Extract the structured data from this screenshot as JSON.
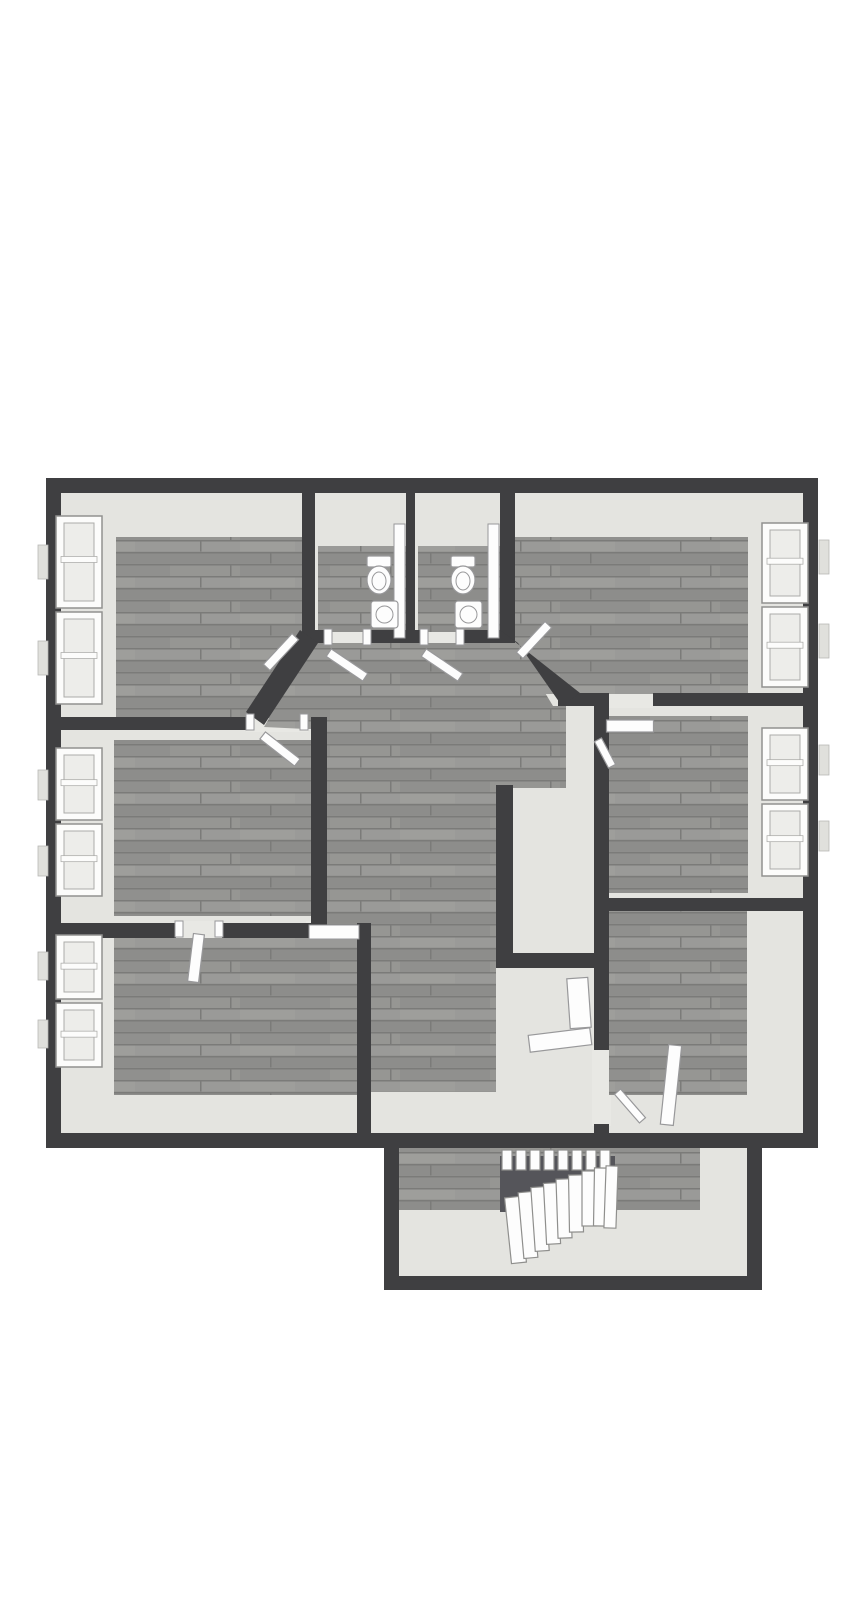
{
  "canvas": {
    "width": 867,
    "height": 1600,
    "background": "#ffffff"
  },
  "palette": {
    "wall": "#3f3f41",
    "floor_light": "#e4e4e0",
    "gap_light": "#e8e8e4",
    "wood_base": "#90908e",
    "wood_row_light": "#9a9a98",
    "wood_row_mid": "#8d8d8b",
    "wood_seam": "#7b7b79",
    "wood_streak": "#a2a2a0",
    "void": "#55555a",
    "white_fixture": "#fdfdfd",
    "fixture_stroke": "#98989a",
    "window_frame": "#fcfcfb",
    "window_frame_stroke": "#91918f",
    "window_pane": "#ededea",
    "window_pane_stroke": "#ababa9",
    "tab_fill": "#e0e0dc",
    "tab_stroke": "#b5b5b3",
    "tread_fill": "#fdfdfd",
    "tread_stroke": "#8f8f8d"
  },
  "floorplan": {
    "light_regions": [
      {
        "name": "room-top-left-base",
        "rect": [
          61,
          493,
          241,
          226
        ]
      },
      {
        "name": "bathroom-left-base",
        "rect": [
          315,
          493,
          91,
          139
        ]
      },
      {
        "name": "bathroom-right-base",
        "rect": [
          415,
          493,
          85,
          139
        ]
      },
      {
        "name": "room-top-right-base",
        "rect": [
          515,
          493,
          288,
          202
        ]
      },
      {
        "name": "room-mid-left-base",
        "rect": [
          61,
          730,
          252,
          195
        ]
      },
      {
        "name": "room-mid-right-base",
        "rect": [
          609,
          706,
          194,
          194
        ]
      },
      {
        "name": "room-bottom-left-base",
        "rect": [
          61,
          938,
          296,
          197
        ]
      },
      {
        "name": "room-bottom-right-base",
        "rect": [
          609,
          911,
          194,
          224
        ]
      },
      {
        "name": "hallway-base",
        "poly": [
          [
            295,
            628
          ],
          [
            520,
            628
          ],
          [
            562,
            692
          ],
          [
            609,
            692
          ],
          [
            609,
            1133
          ],
          [
            368,
            1133
          ],
          [
            368,
            940
          ],
          [
            323,
            940
          ],
          [
            323,
            712
          ],
          [
            244,
            712
          ]
        ]
      },
      {
        "name": "stairwell-base",
        "rect": [
          399,
          1148,
          348,
          128
        ]
      },
      {
        "name": "doorway-threshold",
        "rect": [
          246,
          710,
          62,
          22
        ]
      },
      {
        "name": "doorway-threshold",
        "rect": [
          322,
          628,
          52,
          17
        ]
      },
      {
        "name": "doorway-threshold",
        "rect": [
          418,
          628,
          49,
          17
        ]
      },
      {
        "name": "doorway-threshold",
        "rect": [
          306,
          921,
          54,
          19
        ]
      },
      {
        "name": "doorway-threshold",
        "rect": [
          174,
          921,
          50,
          19
        ]
      },
      {
        "name": "doorway-threshold",
        "rect": [
          605,
          690,
          48,
          18
        ]
      },
      {
        "name": "doorway-threshold",
        "rect": [
          592,
          1046,
          19,
          80
        ]
      }
    ],
    "wood_regions": [
      {
        "name": "room-top-left-floor",
        "rect": [
          116,
          537,
          186,
          181
        ]
      },
      {
        "name": "bathroom-left-floor",
        "rect": [
          318,
          546,
          88,
          86
        ]
      },
      {
        "name": "bathroom-right-floor",
        "rect": [
          418,
          546,
          82,
          86
        ]
      },
      {
        "name": "room-top-right-floor",
        "rect": [
          515,
          537,
          233,
          157
        ]
      },
      {
        "name": "room-mid-left-floor",
        "rect": [
          114,
          740,
          199,
          176
        ]
      },
      {
        "name": "room-mid-right-floor",
        "rect": [
          609,
          716,
          139,
          177
        ]
      },
      {
        "name": "room-bottom-left-floor",
        "rect": [
          114,
          938,
          243,
          157
        ]
      },
      {
        "name": "room-bottom-right-floor",
        "rect": [
          609,
          911,
          138,
          184
        ]
      },
      {
        "name": "hallway-floor",
        "poly": [
          [
            312,
            643
          ],
          [
            515,
            643
          ],
          [
            553,
            706
          ],
          [
            566,
            706
          ],
          [
            566,
            788
          ],
          [
            496,
            788
          ],
          [
            496,
            1092
          ],
          [
            370,
            1092
          ],
          [
            370,
            938
          ],
          [
            327,
            938
          ],
          [
            327,
            730
          ],
          [
            264,
            727
          ]
        ]
      },
      {
        "name": "stairwell-floor-strip",
        "rect": [
          399,
          1148,
          301,
          62
        ]
      }
    ],
    "void": {
      "name": "stair-void",
      "rect": [
        500,
        1156,
        115,
        56
      ]
    },
    "stairs": {
      "upper": {
        "x": 502,
        "y": 1150,
        "w": 10,
        "h": 20,
        "gap": 4,
        "count": 8
      },
      "fan": [
        [
          508,
          1197,
          15,
          66,
          -6
        ],
        [
          521,
          1192,
          14,
          66,
          -5
        ],
        [
          533,
          1187,
          14,
          64,
          -4
        ],
        [
          545,
          1183,
          14,
          61,
          -3
        ],
        [
          557,
          1179,
          14,
          59,
          -2
        ],
        [
          569,
          1175,
          14,
          57,
          -1
        ],
        [
          582,
          1171,
          14,
          55,
          0
        ],
        [
          594,
          1168,
          14,
          58,
          1
        ],
        [
          605,
          1166,
          12,
          62,
          2
        ]
      ]
    },
    "walls": [
      {
        "name": "outer-wall-top",
        "rect": [
          46,
          478,
          772,
          15
        ]
      },
      {
        "name": "outer-wall-left",
        "rect": [
          46,
          478,
          15,
          670
        ]
      },
      {
        "name": "outer-wall-right",
        "rect": [
          803,
          478,
          15,
          670
        ]
      },
      {
        "name": "outer-wall-bottom",
        "rect": [
          46,
          1133,
          772,
          15
        ]
      },
      {
        "name": "stairwell-wall-left",
        "rect": [
          384,
          1148,
          15,
          142
        ]
      },
      {
        "name": "stairwell-wall-right",
        "rect": [
          747,
          1148,
          15,
          142
        ]
      },
      {
        "name": "stairwell-wall-bottom",
        "rect": [
          384,
          1276,
          378,
          14
        ]
      },
      {
        "name": "wall-topleft-bath",
        "rect": [
          302,
          492,
          13,
          140
        ]
      },
      {
        "name": "wall-between-baths",
        "rect": [
          406,
          492,
          9,
          140
        ]
      },
      {
        "name": "wall-bath-topright",
        "rect": [
          500,
          492,
          15,
          140
        ]
      },
      {
        "name": "wall-bath-bottom-a",
        "rect": [
          302,
          630,
          22,
          13
        ]
      },
      {
        "name": "wall-bath-bottom-b",
        "rect": [
          371,
          630,
          49,
          13
        ]
      },
      {
        "name": "wall-bath-bottom-c",
        "rect": [
          464,
          630,
          51,
          13
        ]
      },
      {
        "name": "wall-topleft-bottom",
        "rect": [
          46,
          717,
          200,
          13
        ]
      },
      {
        "name": "wall-midleft-right",
        "rect": [
          311,
          717,
          16,
          210
        ]
      },
      {
        "name": "wall-midleft-bottom-a",
        "rect": [
          46,
          923,
          130,
          15
        ]
      },
      {
        "name": "wall-midleft-bottom-b",
        "rect": [
          222,
          923,
          89,
          15
        ]
      },
      {
        "name": "wall-bottomleft-right",
        "rect": [
          357,
          923,
          14,
          225
        ]
      },
      {
        "name": "wall-topright-bottom-a",
        "rect": [
          558,
          693,
          49,
          13
        ]
      },
      {
        "name": "wall-topright-bottom-b",
        "rect": [
          653,
          693,
          165,
          13
        ]
      },
      {
        "name": "wall-midright-left-a",
        "rect": [
          594,
          693,
          15,
          357
        ]
      },
      {
        "name": "wall-midright-left-b",
        "rect": [
          594,
          1124,
          15,
          24
        ]
      },
      {
        "name": "wall-midright-bottom",
        "rect": [
          594,
          898,
          224,
          13
        ]
      },
      {
        "name": "wall-hall-nook-vertical",
        "rect": [
          496,
          785,
          17,
          168
        ]
      },
      {
        "name": "wall-hall-nook-horizontal",
        "rect": [
          496,
          953,
          113,
          15
        ]
      },
      {
        "name": "wall-angled-left",
        "poly": [
          [
            300,
            630
          ],
          [
            318,
            643
          ],
          [
            264,
            725
          ],
          [
            246,
            712
          ]
        ]
      },
      {
        "name": "wall-angled-right",
        "poly": [
          [
            500,
            630
          ],
          [
            518,
            643
          ],
          [
            562,
            706
          ],
          [
            580,
            693
          ]
        ]
      }
    ],
    "windows": [
      {
        "name": "window-top-left-upper",
        "rect": [
          56,
          516,
          46,
          92
        ]
      },
      {
        "name": "window-top-left-lower",
        "rect": [
          56,
          612,
          46,
          92
        ]
      },
      {
        "name": "window-mid-left-upper",
        "rect": [
          56,
          748,
          46,
          72
        ]
      },
      {
        "name": "window-mid-left-lower",
        "rect": [
          56,
          824,
          46,
          72
        ]
      },
      {
        "name": "window-bottom-left-upper",
        "rect": [
          56,
          935,
          46,
          64
        ]
      },
      {
        "name": "window-bottom-left-lower",
        "rect": [
          56,
          1003,
          46,
          64
        ]
      },
      {
        "name": "window-top-right-upper",
        "rect": [
          762,
          523,
          46,
          80
        ]
      },
      {
        "name": "window-top-right-lower",
        "rect": [
          762,
          607,
          46,
          80
        ]
      },
      {
        "name": "window-mid-right-upper",
        "rect": [
          762,
          728,
          46,
          72
        ]
      },
      {
        "name": "window-mid-right-lower",
        "rect": [
          762,
          804,
          46,
          72
        ]
      }
    ],
    "tabs": [
      [
        38,
        545,
        10,
        34
      ],
      [
        38,
        641,
        10,
        34
      ],
      [
        38,
        770,
        10,
        30
      ],
      [
        38,
        846,
        10,
        30
      ],
      [
        38,
        952,
        10,
        28
      ],
      [
        38,
        1020,
        10,
        28
      ],
      [
        819,
        540,
        10,
        34
      ],
      [
        819,
        624,
        10,
        34
      ],
      [
        819,
        745,
        10,
        30
      ],
      [
        819,
        821,
        10,
        30
      ]
    ],
    "doors": [
      {
        "name": "door-top-left-room",
        "c": [
          281,
          652,
          42,
          9,
          -47
        ]
      },
      {
        "name": "door-mid-left-room",
        "c": [
          280,
          749,
          44,
          9,
          38
        ]
      },
      {
        "name": "door-bathroom-left",
        "c": [
          347,
          665,
          44,
          9,
          34
        ]
      },
      {
        "name": "door-bathroom-right",
        "c": [
          442,
          665,
          44,
          9,
          34
        ]
      },
      {
        "name": "door-top-right-room",
        "c": [
          534,
          640,
          42,
          9,
          -47
        ]
      },
      {
        "name": "door-mid-right-room",
        "c": [
          630,
          726,
          47,
          12,
          0
        ]
      },
      {
        "name": "door-frame-mid-right",
        "c": [
          605,
          753,
          30,
          8,
          62
        ]
      },
      {
        "name": "door-bottom-left-room",
        "c": [
          196,
          958,
          11,
          48,
          7
        ]
      },
      {
        "name": "door-bottom-right-room",
        "c": [
          671,
          1085,
          13,
          80,
          6
        ]
      },
      {
        "name": "door-frame-bottom-right",
        "c": [
          630,
          1106,
          38,
          8,
          49
        ]
      },
      {
        "name": "door-hall-nook",
        "c": [
          560,
          1040,
          62,
          17,
          -7
        ]
      },
      {
        "name": "door-leaf-nook-standing",
        "c": [
          579,
          1003,
          21,
          50,
          -4
        ]
      }
    ],
    "jambs": [
      [
        324,
        629,
        8,
        16
      ],
      [
        363,
        629,
        8,
        16
      ],
      [
        420,
        629,
        8,
        16
      ],
      [
        456,
        629,
        8,
        16
      ],
      [
        246,
        714,
        8,
        16
      ],
      [
        300,
        714,
        8,
        16
      ],
      [
        175,
        921,
        8,
        16
      ],
      [
        215,
        921,
        8,
        16
      ],
      [
        309,
        925,
        50,
        14
      ]
    ],
    "fixtures": {
      "partitions": [
        [
          394,
          524,
          11,
          114
        ],
        [
          488,
          524,
          11,
          114
        ]
      ],
      "toilets": [
        {
          "cx": 379,
          "cy": 578
        },
        {
          "cx": 463,
          "cy": 578
        }
      ],
      "sinks": [
        [
          371,
          601,
          27,
          27
        ],
        [
          455,
          601,
          27,
          27
        ]
      ]
    }
  }
}
